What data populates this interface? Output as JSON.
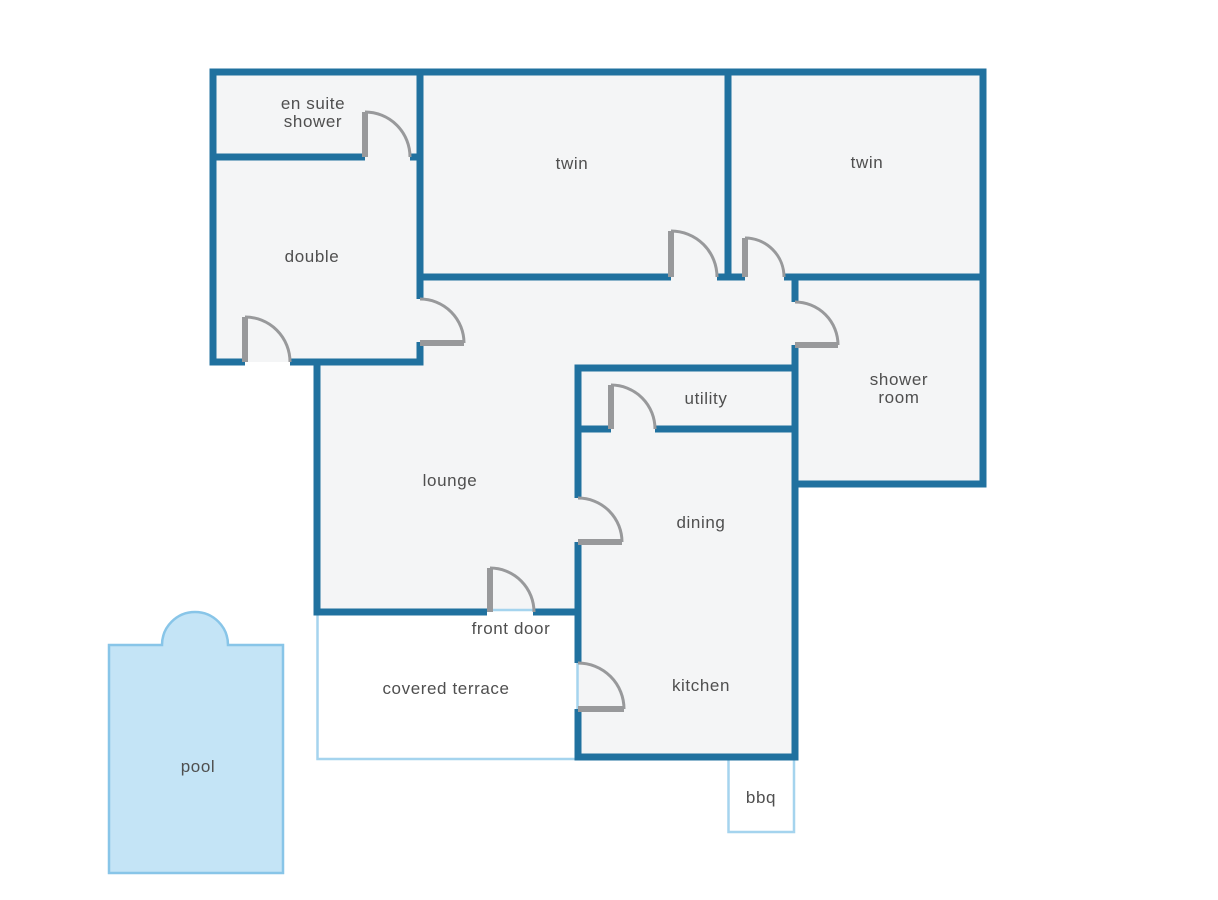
{
  "colors": {
    "background": "#ffffff",
    "wall": "#20719f",
    "floor": "#f4f5f6",
    "door": "#98999b",
    "label": "#4f4f4f",
    "outdoor_border": "#a5d4ee",
    "pool_fill": "#c4e4f6",
    "pool_border": "#88c5e8"
  },
  "labels": {
    "en_suite_line1": "en suite",
    "en_suite_line2": "shower",
    "double_bedroom": "double",
    "twin_middle": "twin",
    "twin_right": "twin",
    "shower_room_line1": "shower",
    "shower_room_line2": "room",
    "utility": "utility",
    "lounge": "lounge",
    "dining": "dining",
    "kitchen": "kitchen",
    "front_door": "front door",
    "covered_terrace": "covered terrace",
    "bbq": "bbq",
    "pool": "pool"
  }
}
